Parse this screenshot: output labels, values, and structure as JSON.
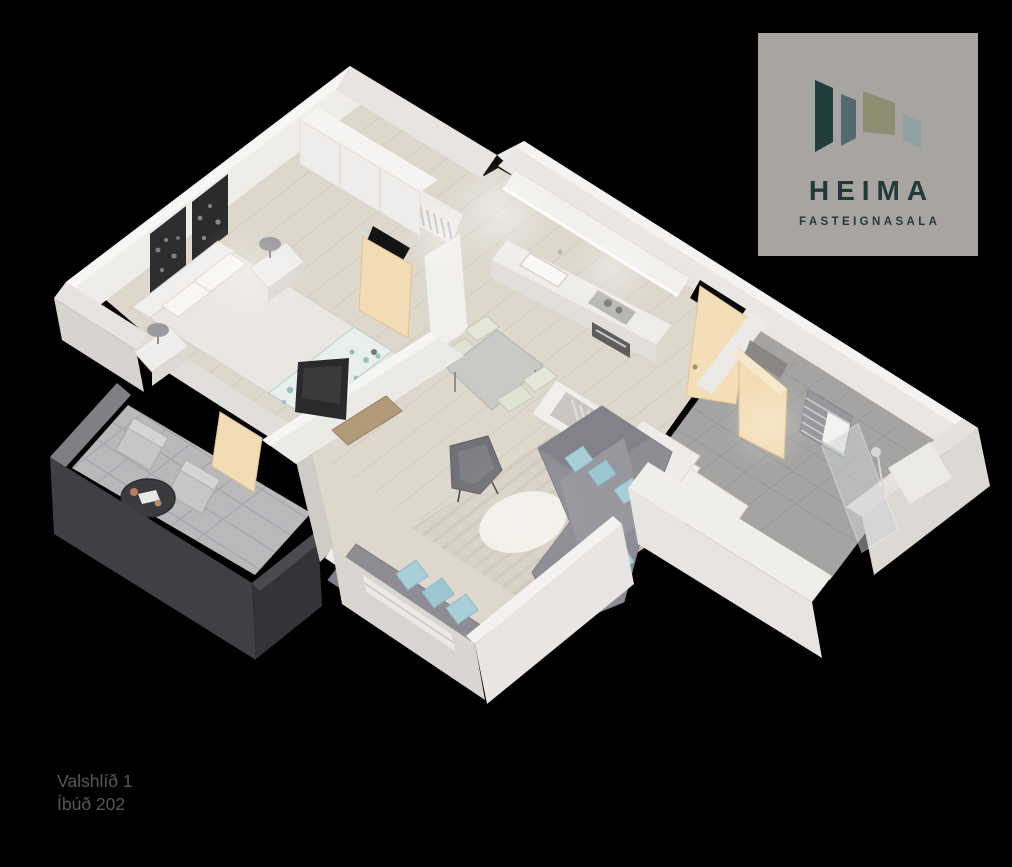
{
  "page": {
    "background": "#000000"
  },
  "logo": {
    "brand": "HEIMA",
    "tagline": "FASTEIGNASALA",
    "card_bg": "#a7a4a1",
    "text_color": "#1f3a39",
    "mark_colors": [
      "#213d3d",
      "#53696d",
      "#8c8d71",
      "#90a1a4"
    ]
  },
  "caption": {
    "line1": "Valshlíð 1",
    "line2": "Íbúð 202",
    "text_color": "#575757"
  },
  "scene": {
    "type": "isometric-3d-floorplan-render",
    "palette": {
      "wall_light": "#efedea",
      "wall_shadow": "#d8d4d0",
      "wood_floor": "#ddd7cc",
      "tile_floor": "#a5a4a2",
      "paver_floor": "#b9b9bc",
      "balcony_wall": "#3f3f44",
      "door_cream": "#f2dcb4",
      "sofa_gray": "#8e8d93",
      "pillow_blue": "#a8cfd8",
      "rug_beige": "#d9d2c5",
      "round_rug": "#f3f0ea",
      "bed_runner_teal": "#a6c7c1",
      "art_dark": "#2e2e30",
      "tv_dark": "#2a2a2c",
      "radiator_gray": "#97989b",
      "stone_table": "#c9c9c6",
      "chair_pale": "#dfe3d2",
      "copper_accent": "#b77e5e"
    },
    "rooms": [
      {
        "name": "bedroom",
        "furniture": [
          "double-bed",
          "teal-floral-runner",
          "pillows",
          "headboard",
          "nightstands",
          "table-lamps",
          "dark-wall-art",
          "wardrobe",
          "tv",
          "media-console",
          "balcony-door"
        ]
      },
      {
        "name": "kitchen",
        "furniture": [
          "upper-cabinets",
          "counter-with-sink",
          "cooktop",
          "oven",
          "tall-cabinet",
          "open-shelf-with-clothes"
        ]
      },
      {
        "name": "dining",
        "furniture": [
          "stone-top-table",
          "four-pale-chairs"
        ]
      },
      {
        "name": "living-room",
        "furniture": [
          "corner-sofa",
          "window-sofa",
          "armchair",
          "blue-cushions",
          "striped-rug",
          "round-white-rug",
          "side-table"
        ]
      },
      {
        "name": "hallway",
        "furniture": [
          "open-wardrobe-with-clothes",
          "entrance-door"
        ]
      },
      {
        "name": "bathroom",
        "furniture": [
          "walk-in-shower",
          "glass-panel",
          "towel-radiator",
          "vanity",
          "bathroom-door"
        ]
      },
      {
        "name": "balcony",
        "furniture": [
          "two-outdoor-chairs",
          "round-bistro-table",
          "paved-floor"
        ]
      }
    ]
  }
}
